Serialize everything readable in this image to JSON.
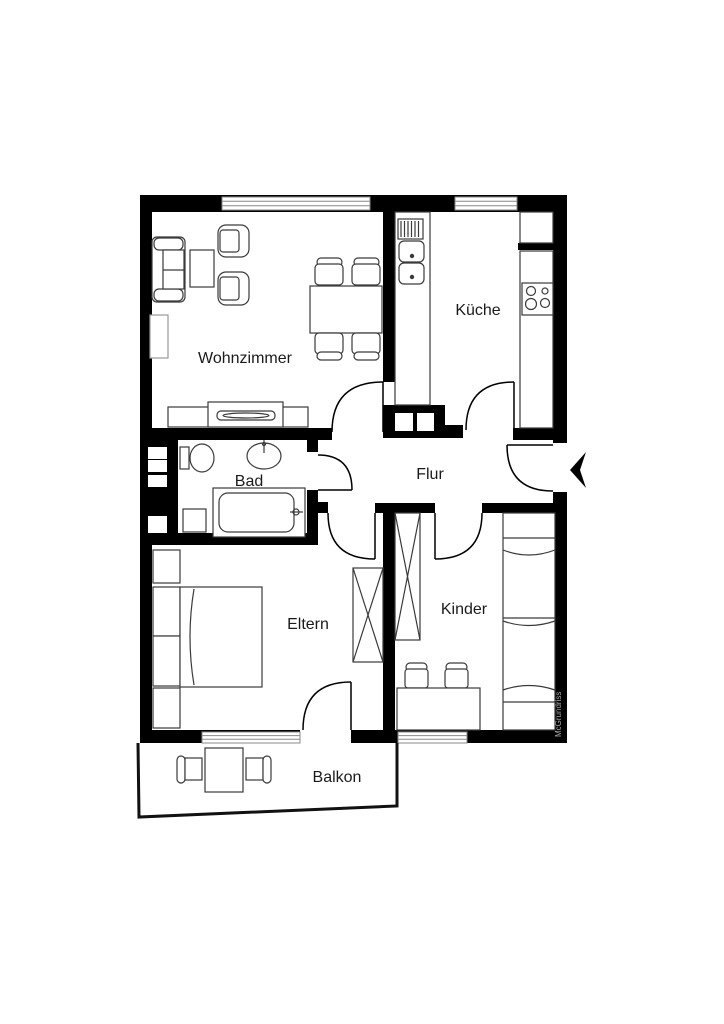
{
  "plan": {
    "type": "apartment-floor-plan",
    "watermark": "McGrundriss",
    "rooms": {
      "living_room": {
        "label": "Wohnzimmer"
      },
      "kitchen": {
        "label": "Küche"
      },
      "bathroom": {
        "label": "Bad"
      },
      "hallway": {
        "label": "Flur"
      },
      "parents_bedroom": {
        "label": "Eltern"
      },
      "kids_room": {
        "label": "Kinder"
      },
      "balcony": {
        "label": "Balkon"
      }
    },
    "colors": {
      "wall": "#000000",
      "background": "#ffffff",
      "furniture_line": "#3a3a3a",
      "window_line": "#888888",
      "door_line": "#000000",
      "outline": "#111111",
      "label_text": "#1a1a1a",
      "watermark_text": "#aaaaaa"
    }
  }
}
